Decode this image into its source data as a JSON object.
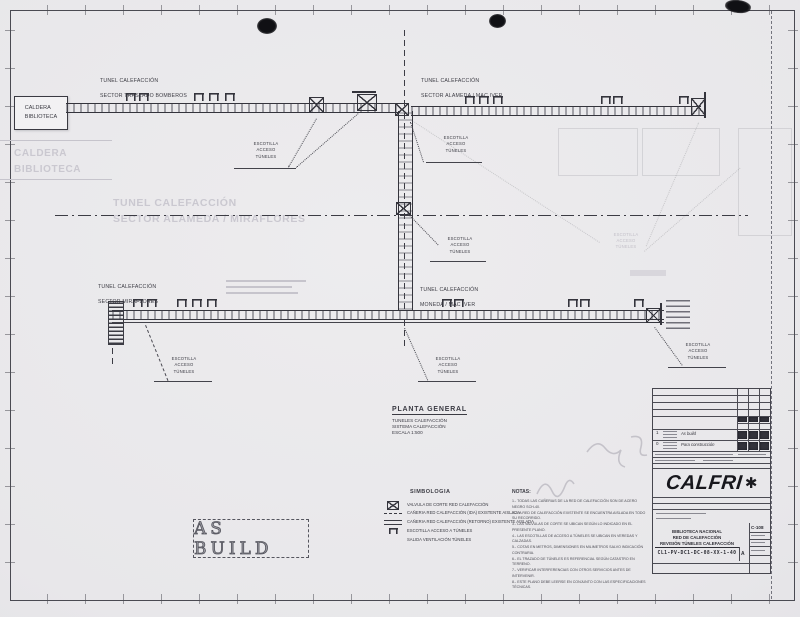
{
  "sheet": {
    "stamp": "AS BUILD"
  },
  "caldera_box": {
    "text": "CALDERA\nBIBLIOTECA"
  },
  "tunnel_labels": {
    "top_left": {
      "line1": "TUNEL CALEFACCIÓN",
      "line2": "SECTOR TRASLADO BOMBEROS"
    },
    "top_right": {
      "line1": "TUNEL CALEFACCIÓN",
      "line2": "SECTOR ALAMEDA / MAC IVER"
    },
    "lower_left": {
      "line1": "TUNEL CALEFACCIÓN",
      "line2": "SECTOR MIRAFLORES"
    },
    "lower_mid": {
      "line1": "TUNEL CALEFACCIÓN",
      "line2": "MONEDA / MAC IVER"
    }
  },
  "escotilla_label": "ESCOTILLA\nACCESO\nTÚNELES",
  "ghost": {
    "caldera": "CALDERA\nBIBLIOTECA",
    "sector": "TUNEL CALEFACCIÓN\nSECTOR ALAMEDA / MIRAFLORES",
    "escotilla": "ESCOTILLA\nACCESO\nTÚNELES"
  },
  "planta": {
    "title": "PLANTA GENERAL",
    "line1": "TUNELES CALEFACCIÓN",
    "line2": "SISTEMA CALEFACCIÓN",
    "line3": "ESCALA 1:500"
  },
  "simbologia": {
    "title": "SIMBOLOGIA",
    "items": [
      {
        "icon": "valve-icon",
        "label": "VALVULA DE CORTE RED CALEFACCIÓN"
      },
      {
        "icon": "dashed-line-icon",
        "label": "CAÑERIA RED CALEFACCIÓN (IDA) EXISTENTE AISLADA"
      },
      {
        "icon": "solid-line-icon",
        "label": "CAÑERIA RED CALEFACCIÓN (RETORNO) EXISTENTE AISLADA"
      },
      {
        "icon": "hatch-icon",
        "label": "ESCOTILLA ACCESO A TÚNELES"
      },
      {
        "icon": "vent-icon",
        "label": "SALIDA VENTILACIÓN TÚNELES"
      }
    ]
  },
  "notas": {
    "title": "NOTAS:",
    "lines": [
      "1.- TODAS LAS CAÑERIAS DE LA RED DE CALEFACCIÓN SON DE ACERO NEGRO SCH-40.",
      "2.- LA RED DE CALEFACCIÓN EXISTENTE SE ENCUENTRA AISLADA EN TODO SU RECORRIDO.",
      "3.- LAS VALVULAS DE CORTE SE UBICAN SEGÚN LO INDICADO EN EL PRESENTE PLANO.",
      "4.- LAS ESCOTILLAS DE ACCESO A TÚNELES SE UBICAN EN VEREDAS Y CALZADAS.",
      "5.- COTAS EN METROS, DIMENSIONES EN MILIMETROS SALVO INDICACIÓN CONTRARIA.",
      "6.- EL TRAZADO DE TÚNELES ES REFERENCIAL SEGÚN CATASTRO EN TERRENO.",
      "7.- VERIFICAR INTERFERENCIAS CON OTROS SERVICIOS ANTES DE INTERVENIR.",
      "8.- ESTE PLANO DEBE LEERSE EN CONJUNTO CON LAS ESPECIFICACIONES TÉCNICAS."
    ]
  },
  "titleblock": {
    "logo": "CALFRI",
    "logo_star": "✱",
    "rev_rows": [
      {
        "rev": "1",
        "desc": "As build"
      },
      {
        "rev": "0",
        "desc": "Para construcción"
      }
    ],
    "project_line1": "BIBLIOTECA NACIONAL",
    "project_line2": "RED DE CALEFACCIÓN",
    "project_line3": "REVISIÓN TÚNELES CALEFACCIÓN",
    "drawing_number": "CL1-PV-DC1-DC-08-XX-1-40",
    "rev_letter": "A",
    "sheet_code": "C-108"
  }
}
